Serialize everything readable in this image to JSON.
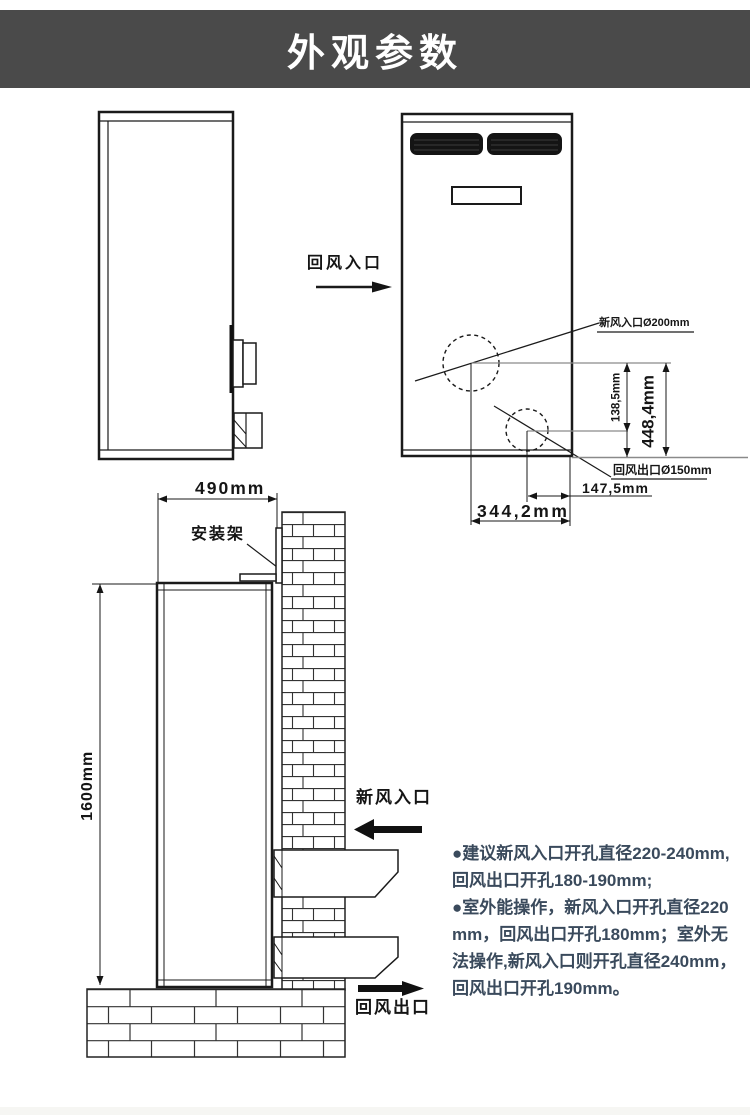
{
  "title": "外观参数",
  "colors": {
    "header_bg": "#4a4a4a",
    "title_text": "#ffffff",
    "drawing_line": "#1a1a1a",
    "reference_line_gray": "#8a8a8a",
    "notes_text": "#3a4a5c"
  },
  "front_view": {
    "return_air_inlet_label": "回风入口",
    "fresh_air_hole_label": "新风入口Ø200mm",
    "return_air_outlet_hole_label": "回风出口Ø150mm",
    "dim_hole_spacing": "138,5mm",
    "dim_hole_height": "448,4mm",
    "dim_outlet_offset": "147,5mm",
    "dim_inlet_offset": "344,2mm"
  },
  "install_view": {
    "dim_width": "490mm",
    "bracket_label": "安装架",
    "dim_height": "1600mm",
    "fresh_air_inlet_label": "新风入口",
    "return_air_outlet_label": "回风出口"
  },
  "notes": {
    "lines": [
      "●建议新风入口开孔直径220-240mm,",
      "回风出口开孔180-190mm;",
      "●室外能操作，新风入口开孔直径220",
      "mm，回风出口开孔180mm；室外无",
      "法操作,新风入口则开孔直径240mm，",
      "回风出口开孔190mm。"
    ]
  }
}
